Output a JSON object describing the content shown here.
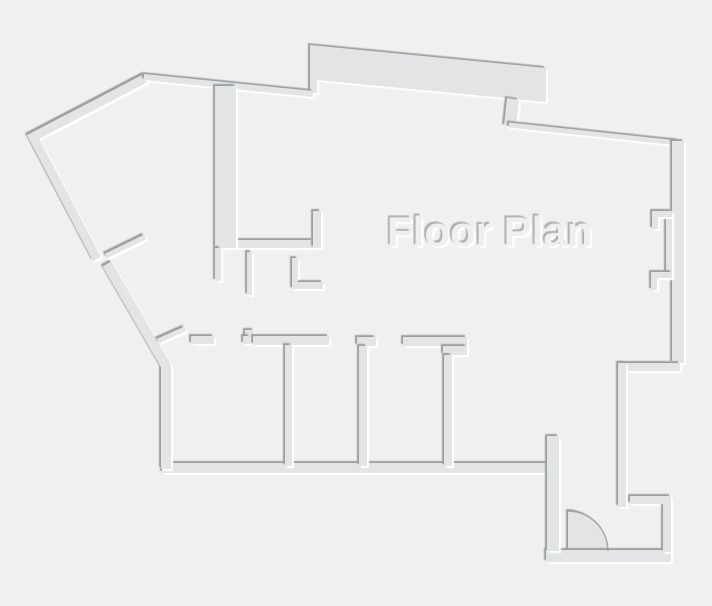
{
  "title": {
    "label": "Floor Plan"
  },
  "canvas": {
    "width": 712,
    "height": 606,
    "background": "#f0f0f0",
    "wall_fill": "#e2e4e5",
    "edge_shadow": "#9b9ea0",
    "edge_highlight": "#ffffff",
    "title_color": "#edeff0",
    "title_shadow_dark": "#aeb1b2",
    "title_shadow_light": "#ffffff"
  },
  "floor_plan": {
    "shapes": [
      {
        "name": "top-band-wall",
        "kind": "fill",
        "d": "M310,45 L546,68 L546,102 L317,80 L317,93 L310,93 Z"
      },
      {
        "name": "band-connector-wall",
        "kind": "fill",
        "d": "M507,98 L519,100 L516,128 L504,126 Z"
      },
      {
        "name": "top-right-wall",
        "kind": "line",
        "d": "M509,125 L678,143",
        "w": 5
      },
      {
        "name": "right-wall",
        "kind": "fill",
        "d": "M672,141 H684 V363 H672 Z"
      },
      {
        "name": "right-wall-lining",
        "kind": "fill",
        "d": "M666,216 H672 V274 H666 Z"
      },
      {
        "name": "pilaster-upper",
        "kind": "fill",
        "d": "M652,211 H672 V217 H658 V229 H652 Z"
      },
      {
        "name": "pilaster-lower",
        "kind": "fill",
        "d": "M651,272 H672 V278 H657 V290 H651 Z"
      },
      {
        "name": "right-step-wall",
        "kind": "fill",
        "d": "M619,363 H680 V371 H619 Z"
      },
      {
        "name": "right-inner-wall",
        "kind": "fill",
        "d": "M618,363 H626 V507 H618 Z"
      },
      {
        "name": "door-swing",
        "kind": "fill",
        "d": "M568,551 V511 A40,40 0 0 1 608,551 Z"
      },
      {
        "name": "bottom-entry-wall",
        "kind": "fill",
        "d": "M546,550 H671 V562 H546 Z"
      },
      {
        "name": "entry-nook-wall",
        "kind": "fill",
        "d": "M630,496 H671 V552 H663 V504 H630 Z"
      },
      {
        "name": "rooms-bottom-wall",
        "kind": "fill",
        "d": "M162,463 H550 V473 H162 Z"
      },
      {
        "name": "entry-post-wall",
        "kind": "fill",
        "d": "M547,436 H559 V551 H547 Z"
      },
      {
        "name": "left-lower-wall",
        "kind": "line",
        "d": "M107,264 L166,366 L166,469",
        "w": 10
      },
      {
        "name": "left-upper-wall",
        "kind": "line",
        "d": "M146,78 L33,137 L97,259",
        "w": 9
      },
      {
        "name": "door-leaf-upper",
        "kind": "line",
        "d": "M106,256 L145,237",
        "w": 5
      },
      {
        "name": "door-leaf-lower",
        "kind": "line",
        "d": "M158,341 L185,329",
        "w": 5
      },
      {
        "name": "top-wall",
        "kind": "line",
        "d": "M144,77 L313,94",
        "w": 6
      },
      {
        "name": "hall-wall-horizontal",
        "kind": "fill",
        "d": "M236,240 H313 V248 H236 Z"
      },
      {
        "name": "hall-column-wall",
        "kind": "fill",
        "d": "M215,86 H236 V248 H215 Z"
      },
      {
        "name": "hall-stub-up",
        "kind": "fill",
        "d": "M313,211 H321 V248 H313 Z"
      },
      {
        "name": "hall-wall-lower",
        "kind": "fill",
        "d": "M215,248 H221 V281 H215 Z"
      },
      {
        "name": "hall-stub-a",
        "kind": "fill",
        "d": "M247,252 H252 V295 H247 Z"
      },
      {
        "name": "hall-stub-b",
        "kind": "fill",
        "d": "M292,258 H298 V282 H323 V289 H292 Z"
      },
      {
        "name": "room1-top-wall-a",
        "kind": "fill",
        "d": "M191,336 H214 V344 H191 Z"
      },
      {
        "name": "room1-top-jog-a",
        "kind": "fill",
        "d": "M245,330 H254 V337 H245 Z"
      },
      {
        "name": "room1-top-jog-b",
        "kind": "fill",
        "d": "M243,336 H250 V344 H243 Z"
      },
      {
        "name": "room1-top-wall-b",
        "kind": "fill",
        "d": "M253,336 H329 V345 H253 Z"
      },
      {
        "name": "room-divider-1",
        "kind": "fill",
        "d": "M285,345 H292 V466 H285 Z"
      },
      {
        "name": "room2-top-wall",
        "kind": "fill",
        "d": "M357,337 H376 V346 H357 Z"
      },
      {
        "name": "room-divider-2",
        "kind": "fill",
        "d": "M359,346 H367 V466 H359 Z"
      },
      {
        "name": "room3-top-wall",
        "kind": "fill",
        "d": "M403,337 H467 V346 H403 Z"
      },
      {
        "name": "room3-top-block",
        "kind": "fill",
        "d": "M443,346 H467 V355 H443 Z"
      },
      {
        "name": "room-divider-3",
        "kind": "fill",
        "d": "M444,355 H452 V466 H444 Z"
      },
      {
        "name": "door-swing-arc",
        "kind": "overlay",
        "d": "M568,511 A40,40 0 0 1 608,551",
        "w": 1.6
      }
    ]
  }
}
